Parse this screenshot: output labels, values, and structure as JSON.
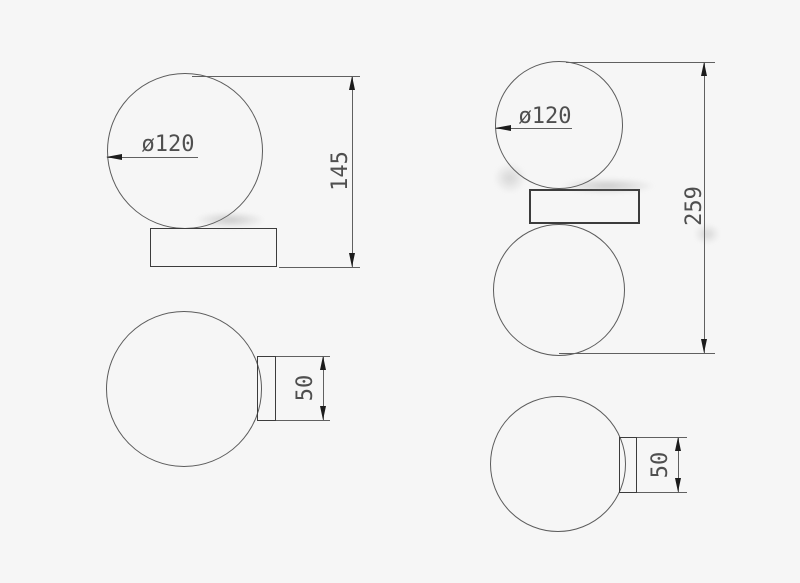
{
  "colors": {
    "background": "#f6f6f6",
    "thin_line": "#606060",
    "outline": "#3c3c3c",
    "arrow": "#1c1c1c",
    "text": "#4f4f4f"
  },
  "views": {
    "front_single": {
      "diameter": "ø120",
      "height": "145"
    },
    "front_double": {
      "diameter": "ø120",
      "height": "259"
    },
    "side_single": {
      "depth": "50"
    },
    "side_double": {
      "depth": "50"
    }
  }
}
